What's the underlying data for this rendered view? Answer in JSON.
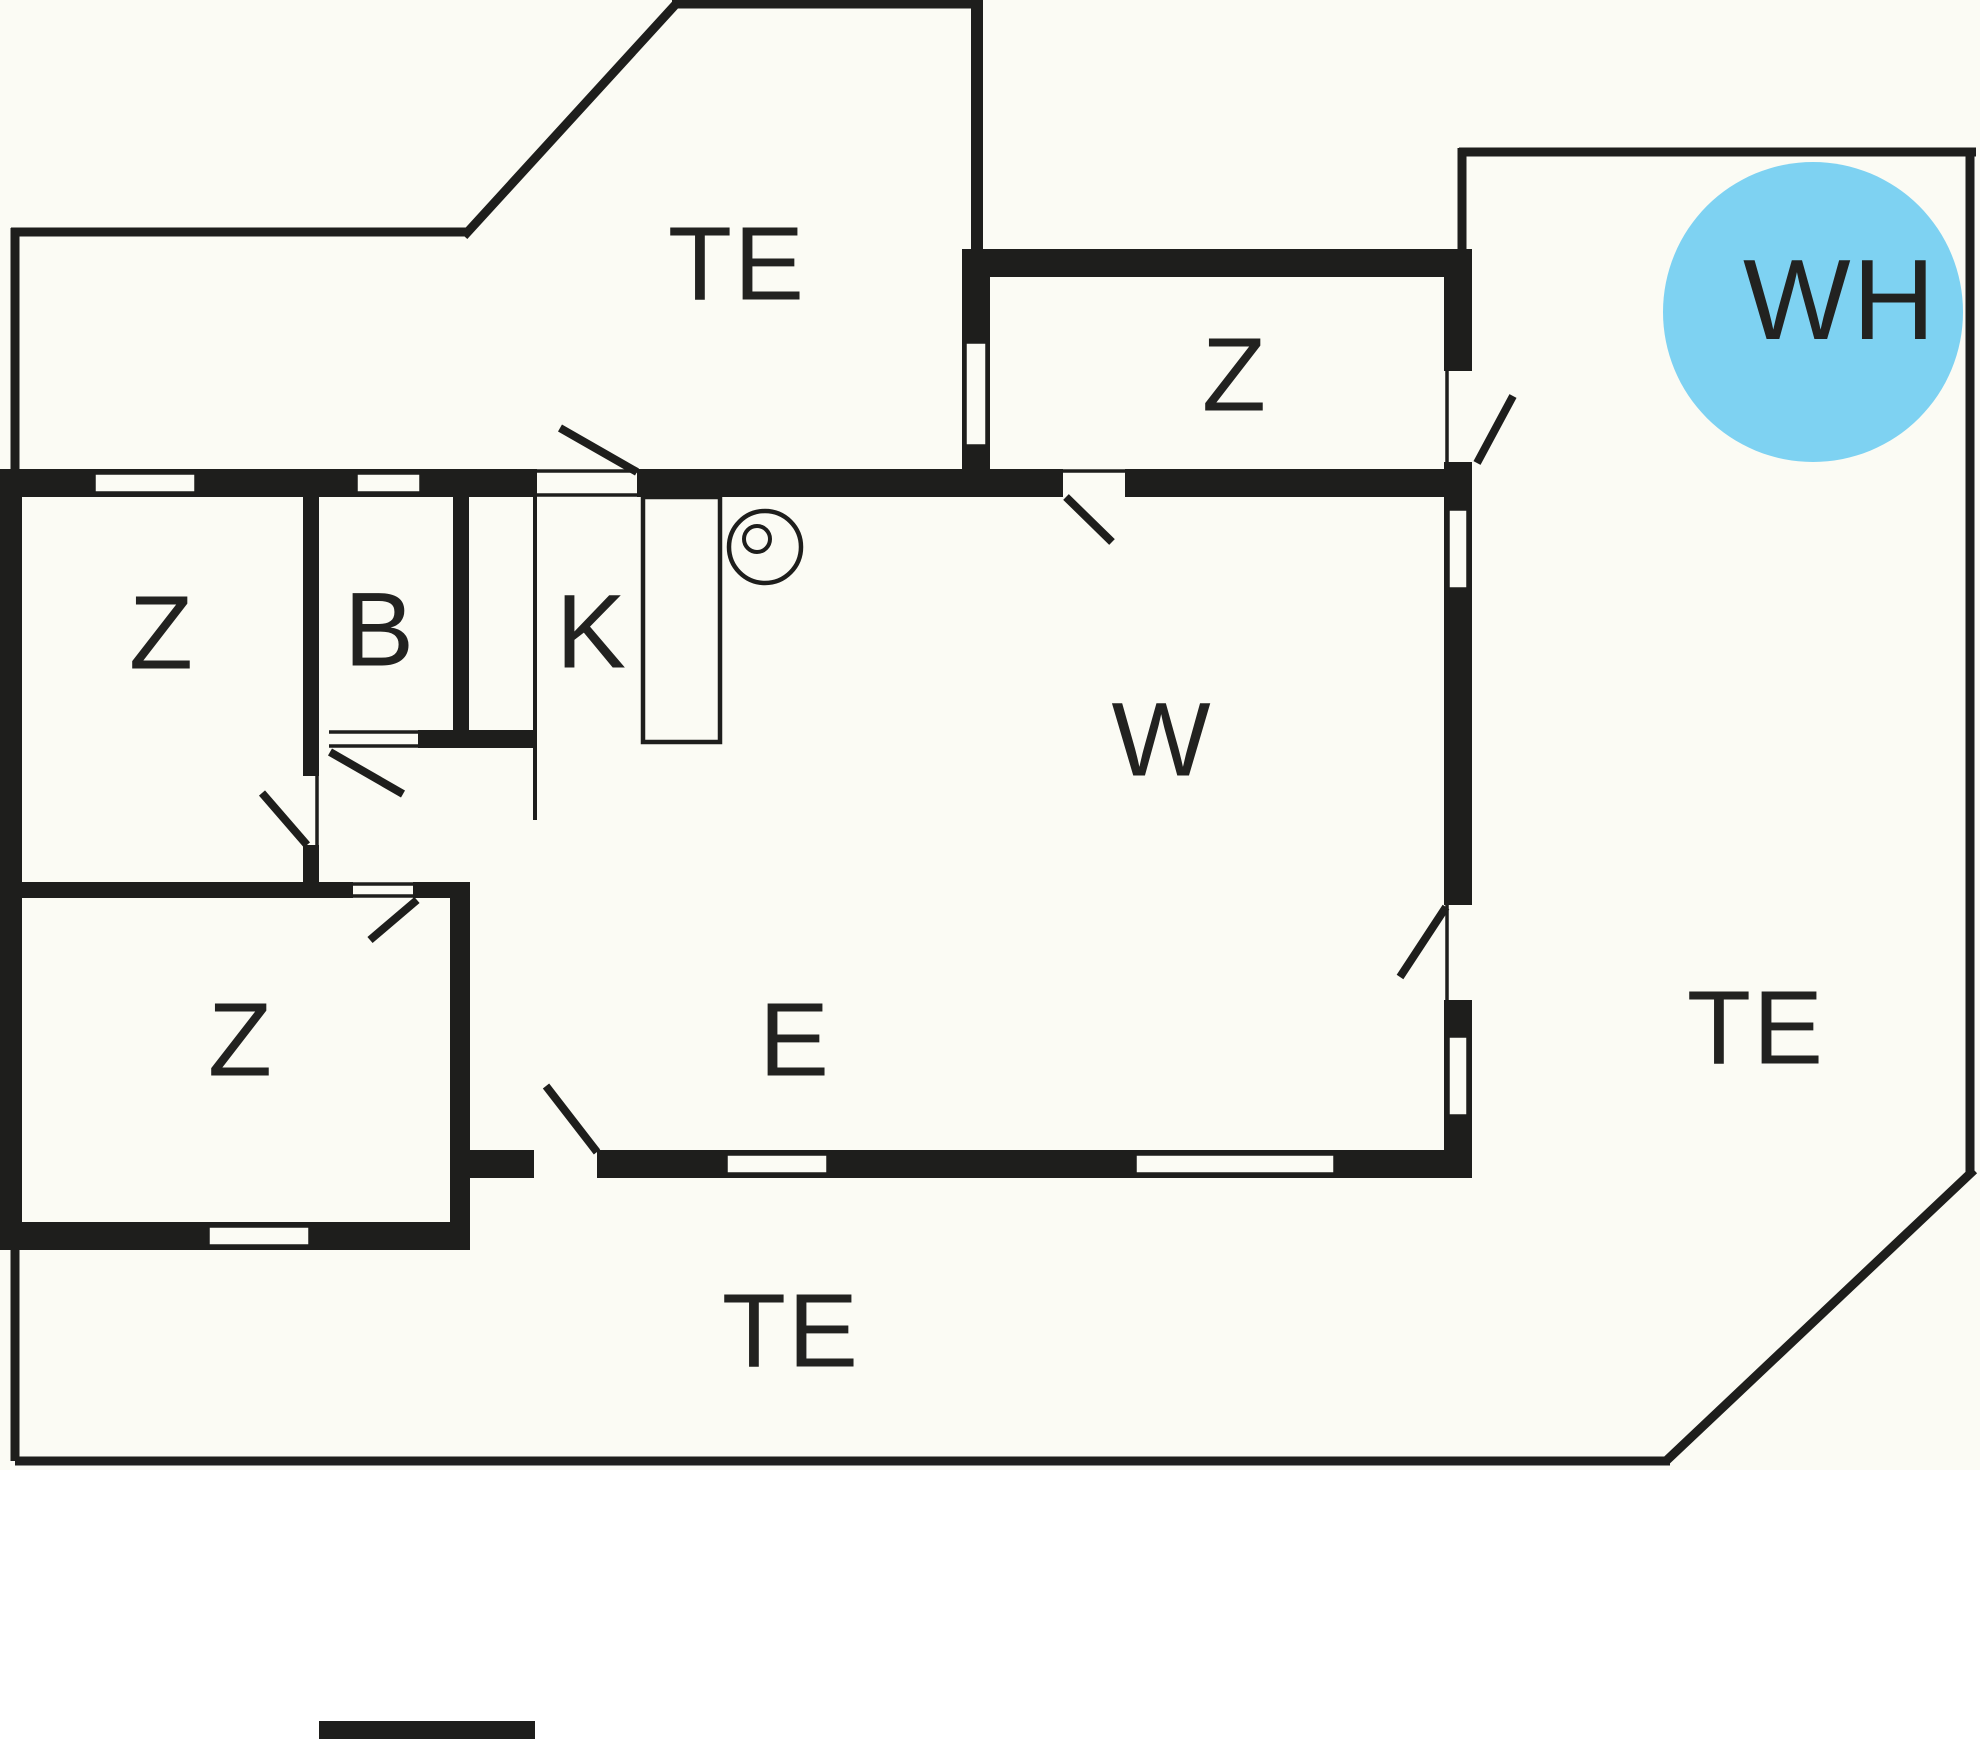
{
  "canvas": {
    "width": 1980,
    "height": 1739,
    "background": "#FBFBF4",
    "wall_color": "#1E1E1C",
    "accent_blue": "#7ED2F2",
    "text_color": "#222220"
  },
  "rooms": [
    {
      "id": "terrace-top",
      "label": "TE",
      "x": 737,
      "y": 264,
      "font": 105
    },
    {
      "id": "bedroom-topright",
      "label": "Z",
      "x": 1235,
      "y": 375,
      "font": 105
    },
    {
      "id": "whirlpool",
      "label": "WH",
      "x": 1840,
      "y": 301,
      "font": 114
    },
    {
      "id": "bedroom-left",
      "label": "Z",
      "x": 162,
      "y": 633,
      "font": 105
    },
    {
      "id": "bathroom",
      "label": "B",
      "x": 380,
      "y": 630,
      "font": 105
    },
    {
      "id": "kitchen",
      "label": "K",
      "x": 592,
      "y": 632,
      "font": 105
    },
    {
      "id": "living-room",
      "label": "W",
      "x": 1162,
      "y": 740,
      "font": 105
    },
    {
      "id": "bedroom-bottomleft",
      "label": "Z",
      "x": 241,
      "y": 1040,
      "font": 105
    },
    {
      "id": "dining-area",
      "label": "E",
      "x": 795,
      "y": 1040,
      "font": 105
    },
    {
      "id": "terrace-right",
      "label": "TE",
      "x": 1756,
      "y": 1028,
      "font": 105
    },
    {
      "id": "terrace-bottom",
      "label": "TE",
      "x": 791,
      "y": 1331,
      "font": 105
    }
  ],
  "whirlpool_circle": {
    "cx": 1813,
    "cy": 312,
    "r": 150
  },
  "walls": [
    {
      "name": "wall-top",
      "x": 0,
      "y": 469,
      "w": 990,
      "h": 28
    },
    {
      "name": "wall-left",
      "x": 0,
      "y": 469,
      "w": 22,
      "h": 781
    },
    {
      "name": "wall-zroom-left",
      "x": 962,
      "y": 249,
      "w": 28,
      "h": 248
    },
    {
      "name": "wall-zroom-top",
      "x": 962,
      "y": 249,
      "w": 483,
      "h": 28
    },
    {
      "name": "wall-top-right-section",
      "x": 983,
      "y": 469,
      "w": 489,
      "h": 28
    },
    {
      "name": "wall-right",
      "x": 1444,
      "y": 249,
      "w": 28,
      "h": 929
    },
    {
      "name": "wall-bottom-main",
      "x": 450,
      "y": 1150,
      "w": 1022,
      "h": 28
    },
    {
      "name": "wall-bottom-zroom",
      "x": 0,
      "y": 1222,
      "w": 470,
      "h": 28
    },
    {
      "name": "wall-step-vertical",
      "x": 450,
      "y": 882,
      "w": 20,
      "h": 368
    },
    {
      "name": "wall-hallway",
      "x": 22,
      "y": 882,
      "w": 446,
      "h": 16
    },
    {
      "name": "wall-z-b-divider",
      "x": 303,
      "y": 497,
      "w": 16,
      "h": 279
    },
    {
      "name": "wall-z-b-divider-stub",
      "x": 303,
      "y": 845,
      "w": 16,
      "h": 37
    },
    {
      "name": "wall-b-k-divider",
      "x": 453,
      "y": 497,
      "w": 16,
      "h": 251
    },
    {
      "name": "wall-bath-bottom",
      "x": 418,
      "y": 730,
      "w": 117,
      "h": 18
    },
    {
      "name": "wall-terrace-top-bar",
      "x": 971,
      "y": 0,
      "w": 12,
      "h": 249
    }
  ],
  "door_gaps": [
    {
      "name": "door-gap-terrace-kitchen",
      "x": 537,
      "y": 467,
      "w": 100,
      "h": 32
    },
    {
      "name": "door-gap-zroom-living",
      "x": 1063,
      "y": 467,
      "w": 62,
      "h": 32
    },
    {
      "name": "door-gap-zroom-terrace",
      "x": 1443,
      "y": 371,
      "w": 30,
      "h": 91
    },
    {
      "name": "door-gap-living-terrace",
      "x": 1443,
      "y": 905,
      "w": 30,
      "h": 95
    },
    {
      "name": "door-gap-bathroom",
      "x": 329,
      "y": 728,
      "w": 89,
      "h": 22
    },
    {
      "name": "door-gap-bedroom-left",
      "x": 301,
      "y": 776,
      "w": 20,
      "h": 69
    },
    {
      "name": "door-gap-bedroom-bottom",
      "x": 353,
      "y": 880,
      "w": 60,
      "h": 20
    },
    {
      "name": "door-gap-dining-terrace",
      "x": 534,
      "y": 1148,
      "w": 63,
      "h": 32
    }
  ],
  "gap_edge_lines": [
    {
      "name": "jamb-terrace-kitchen-top",
      "x1": 537,
      "y1": 471,
      "x2": 637,
      "y2": 471,
      "w": 3.5
    },
    {
      "name": "jamb-terrace-kitchen-bottom",
      "x1": 537,
      "y1": 495,
      "x2": 637,
      "y2": 495,
      "w": 3.5
    },
    {
      "name": "jamb-zroom-living-top",
      "x1": 1063,
      "y1": 471,
      "x2": 1125,
      "y2": 471,
      "w": 3.5
    },
    {
      "name": "jamb-bathroom-top",
      "x1": 329,
      "y1": 732,
      "x2": 418,
      "y2": 732,
      "w": 3.5
    },
    {
      "name": "jamb-bathroom-bottom",
      "x1": 329,
      "y1": 746,
      "x2": 418,
      "y2": 746,
      "w": 3.5
    },
    {
      "name": "jamb-bedroom-left-side",
      "x1": 317,
      "y1": 776,
      "x2": 317,
      "y2": 845,
      "w": 3.5
    },
    {
      "name": "jamb-bedroom-bottom-top",
      "x1": 353,
      "y1": 884,
      "x2": 413,
      "y2": 884,
      "w": 3.5
    },
    {
      "name": "jamb-bedroom-bottom-bottom",
      "x1": 353,
      "y1": 896,
      "x2": 413,
      "y2": 896,
      "w": 3.5
    },
    {
      "name": "jamb-zroom-terrace-side",
      "x1": 1447,
      "y1": 371,
      "x2": 1447,
      "y2": 462,
      "w": 3.5
    },
    {
      "name": "jamb-living-terrace-side",
      "x1": 1447,
      "y1": 905,
      "x2": 1447,
      "y2": 1000,
      "w": 3.5
    }
  ],
  "windows": [
    {
      "name": "window-top-1",
      "x": 94,
      "y": 473,
      "w": 102,
      "h": 20
    },
    {
      "name": "window-top-2",
      "x": 356,
      "y": 473,
      "w": 65,
      "h": 20
    },
    {
      "name": "window-zroom-left",
      "x": 965,
      "y": 342,
      "w": 22,
      "h": 104
    },
    {
      "name": "window-right-upper",
      "x": 1448,
      "y": 509,
      "w": 20,
      "h": 80
    },
    {
      "name": "window-right-lower",
      "x": 1448,
      "y": 1036,
      "w": 20,
      "h": 80
    },
    {
      "name": "window-bottom-1",
      "x": 726,
      "y": 1154,
      "w": 102,
      "h": 20
    },
    {
      "name": "window-bottom-2",
      "x": 1135,
      "y": 1154,
      "w": 200,
      "h": 20
    },
    {
      "name": "window-zbottom",
      "x": 208,
      "y": 1226,
      "w": 102,
      "h": 20
    }
  ],
  "door_leaves": [
    {
      "name": "leaf-terrace-kitchen",
      "x1": 560,
      "y1": 428,
      "x2": 637,
      "y2": 472
    },
    {
      "name": "leaf-zroom-living",
      "x1": 1066,
      "y1": 497,
      "x2": 1112,
      "y2": 542
    },
    {
      "name": "leaf-zroom-terrace",
      "x1": 1477,
      "y1": 463,
      "x2": 1513,
      "y2": 396
    },
    {
      "name": "leaf-living-terrace",
      "x1": 1446,
      "y1": 907,
      "x2": 1400,
      "y2": 977
    },
    {
      "name": "leaf-bathroom",
      "x1": 330,
      "y1": 752,
      "x2": 403,
      "y2": 794
    },
    {
      "name": "leaf-bedroom-left",
      "x1": 262,
      "y1": 793,
      "x2": 307,
      "y2": 845
    },
    {
      "name": "leaf-bedroom-bottom",
      "x1": 417,
      "y1": 900,
      "x2": 370,
      "y2": 940
    },
    {
      "name": "leaf-dining-terrace",
      "x1": 546,
      "y1": 1086,
      "x2": 597,
      "y2": 1152
    }
  ],
  "terrace_outline": [
    {
      "name": "terrace-topleft-left",
      "x1": 15,
      "y1": 228,
      "x2": 15,
      "y2": 476,
      "w": 9
    },
    {
      "name": "terrace-topleft-top",
      "x1": 11,
      "y1": 232,
      "x2": 467,
      "y2": 232,
      "w": 9
    },
    {
      "name": "terrace-topleft-diag",
      "x1": 464,
      "y1": 236,
      "x2": 676,
      "y2": 4,
      "w": 9
    },
    {
      "name": "terrace-topleft-edge",
      "x1": 672,
      "y1": 4,
      "x2": 977,
      "y2": 4,
      "w": 9
    },
    {
      "name": "terrace-right-top",
      "x1": 1459,
      "y1": 152,
      "x2": 1976,
      "y2": 152,
      "w": 9
    },
    {
      "name": "terrace-right-left",
      "x1": 1462,
      "y1": 148,
      "x2": 1462,
      "y2": 253,
      "w": 9
    },
    {
      "name": "terrace-right-edge",
      "x1": 1970,
      "y1": 148,
      "x2": 1970,
      "y2": 1172,
      "w": 9
    },
    {
      "name": "terrace-corner-diag",
      "x1": 1974,
      "y1": 1170,
      "x2": 1666,
      "y2": 1461,
      "w": 9
    },
    {
      "name": "terrace-bottom-edge",
      "x1": 15,
      "y1": 1461,
      "x2": 1670,
      "y2": 1461,
      "w": 9
    },
    {
      "name": "terrace-bottom-left",
      "x1": 15,
      "y1": 1250,
      "x2": 15,
      "y2": 1461,
      "w": 9
    }
  ],
  "furniture": {
    "kitchen_divider": {
      "name": "kitchen-tall-unit-line",
      "x1": 535,
      "y1": 497,
      "x2": 535,
      "y2": 820,
      "w": 4
    },
    "counter": {
      "name": "kitchen-counter",
      "x": 643,
      "y": 497,
      "w": 77,
      "h": 245,
      "stroke": 4.5
    },
    "stove_outer": {
      "name": "stove-symbol-outer",
      "cx": 765,
      "cy": 547,
      "r": 36,
      "stroke": 4.5
    },
    "stove_inner": {
      "name": "stove-symbol-inner",
      "cx": 757,
      "cy": 539,
      "r": 13,
      "stroke": 4
    }
  },
  "legend_bar": {
    "x": 319,
    "y": 1721,
    "w": 216,
    "h": 18
  }
}
